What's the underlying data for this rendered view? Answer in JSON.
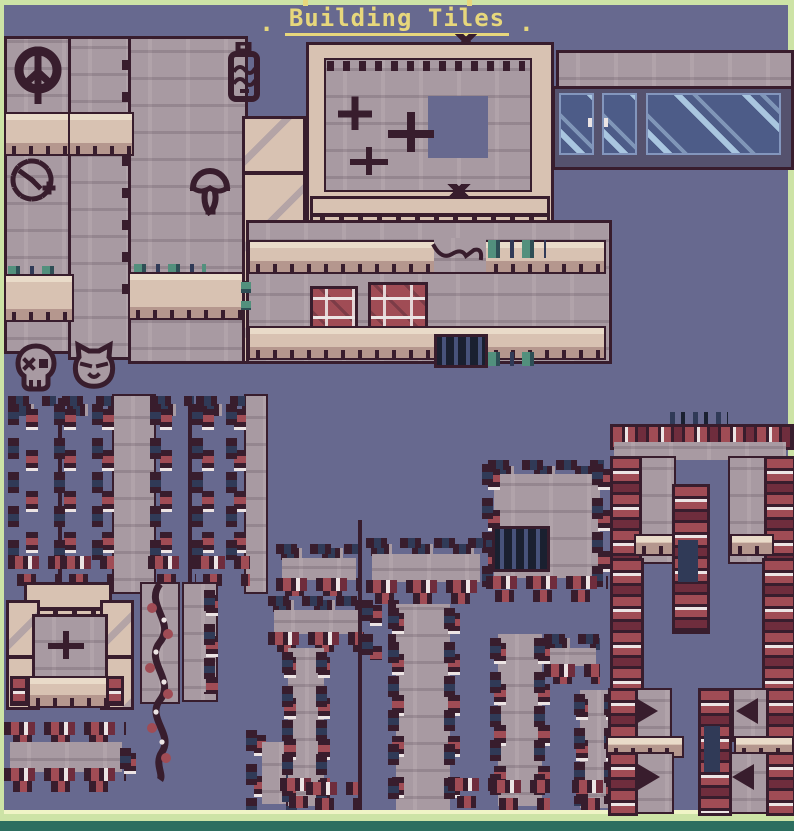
{
  "header": {
    "title": "Building Tiles",
    "flank_left": ".",
    "flank_right": "."
  },
  "palette": {
    "bg": "#67698f",
    "border_green": "#cde3a6",
    "border_pale": "#f0f4c6",
    "border_teal": "#2c6e60",
    "wall": "#a89aa2",
    "wall_dark": "#8e7e89",
    "wall_light": "#c0b2b8",
    "outline": "#381d2d",
    "beige": "#d8c2b2",
    "beige_light": "#e9dbc9",
    "beige_dark": "#b5978e",
    "brick_red": "#a04c55",
    "brick_dark": "#6f2d3d",
    "white_hl": "#ece4e4",
    "vine_navy": "#303a57",
    "moss_teal": "#52907d",
    "moss_dark": "#2e4e55",
    "glass_dark": "#4d5c88",
    "glass_light": "#a9c6e0",
    "frame_gray": "#55526e",
    "title_yellow": "#e7d77c",
    "grate_dark": "#1a2030",
    "grate_bar": "#47527a"
  },
  "graffiti_icons": [
    "peace-sign",
    "clock-face",
    "spray-can",
    "mushroom-cloud",
    "skull",
    "cat-face"
  ],
  "tiles": {
    "groups": [
      "wall-columns-with-graffiti",
      "beige-pillar-segments",
      "framed-wall-panel",
      "glass-window-strip",
      "long-wall-with-ledges",
      "vine-edged-openings",
      "stone-window-frame",
      "winding-vine-column",
      "overgrown-ledge",
      "overgrown-tree-pillars",
      "brick-archway",
      "brick-corner-tiles"
    ]
  }
}
